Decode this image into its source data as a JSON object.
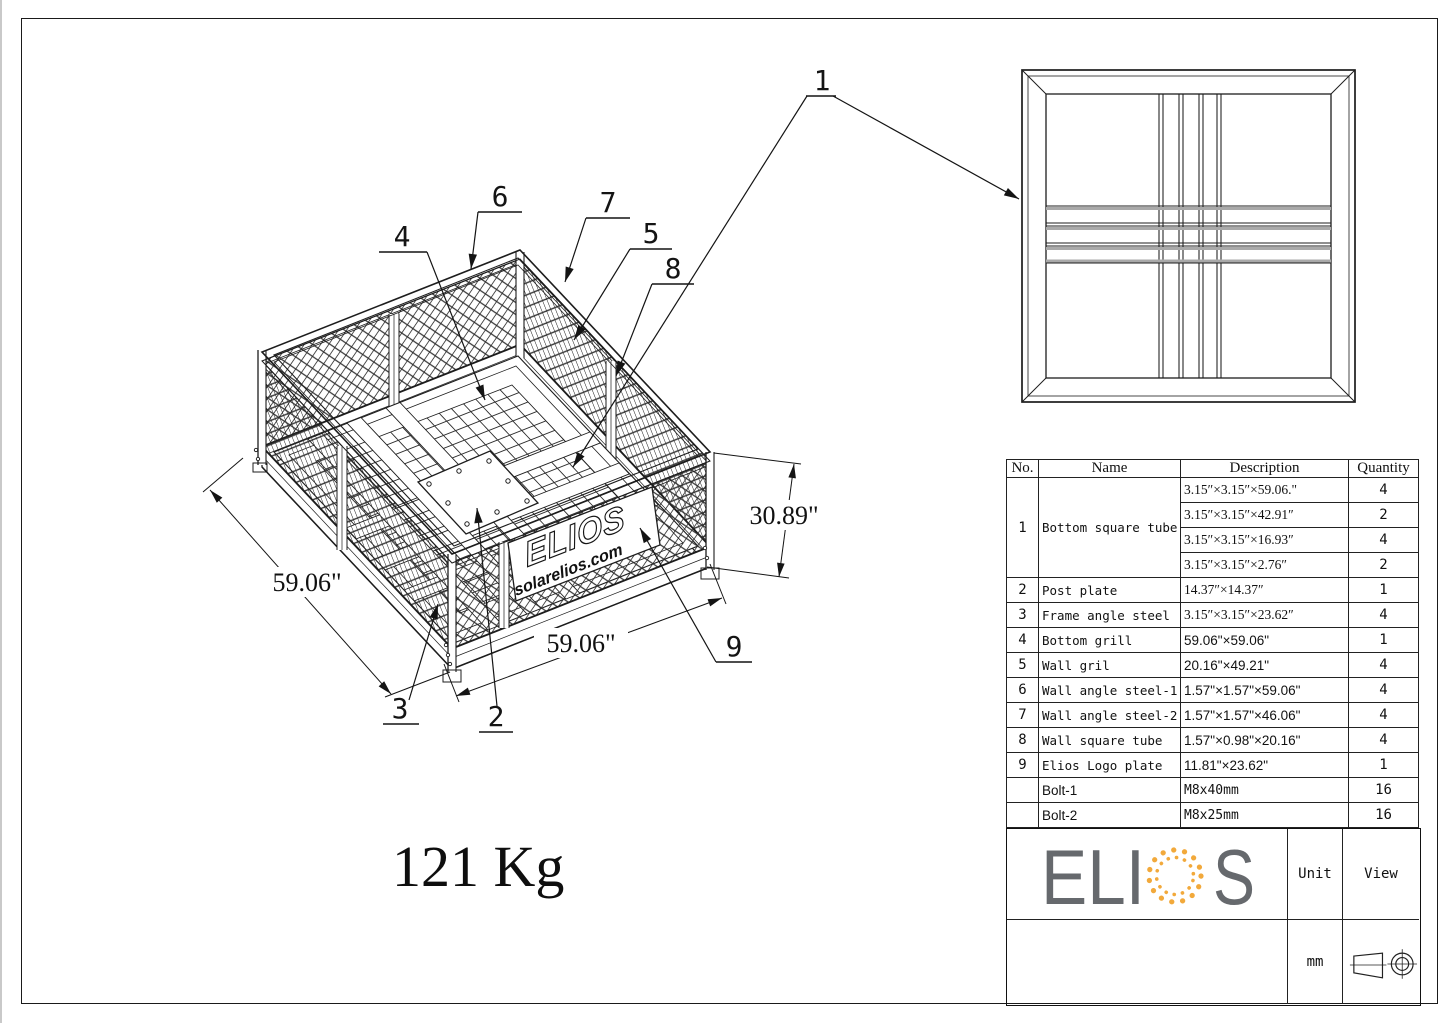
{
  "drawing": {
    "weight_label": "121 Kg",
    "callouts": [
      "1",
      "2",
      "3",
      "4",
      "5",
      "6",
      "7",
      "8",
      "9"
    ],
    "dimensions": {
      "left_width": "59.06\"",
      "front_width": "59.06\"",
      "height": "30.89\""
    },
    "logo_plate": {
      "brand": "ELIOS",
      "website": "solarelios.com"
    }
  },
  "parts_table": {
    "headers": [
      "No.",
      "Name",
      "Description",
      "Quantity"
    ],
    "item1": {
      "no": "1",
      "name": "Bottom square tube",
      "subs": [
        {
          "desc": "3.15″×3.15″×59.06.\"",
          "qty": "4"
        },
        {
          "desc": "3.15″×3.15″×42.91″",
          "qty": "2"
        },
        {
          "desc": "3.15″×3.15″×16.93″",
          "qty": "4"
        },
        {
          "desc": "3.15″×3.15″×2.76″",
          "qty": "2"
        }
      ]
    },
    "rows": [
      {
        "no": "2",
        "name": "Post plate",
        "desc": "14.37″×14.37″",
        "qty": "1"
      },
      {
        "no": "3",
        "name": "Frame angle steel",
        "desc": "3.15″×3.15″×23.62″",
        "qty": "4"
      },
      {
        "no": "4",
        "name": "Bottom grill",
        "desc": "59.06\"×59.06\"",
        "qty": "1"
      },
      {
        "no": "5",
        "name": "Wall gril",
        "desc": "20.16\"×49.21\"",
        "qty": "4"
      },
      {
        "no": "6",
        "name": "Wall angle steel-1",
        "desc": "1.57\"×1.57\"×59.06\"",
        "qty": "4"
      },
      {
        "no": "7",
        "name": "Wall angle steel-2",
        "desc": "1.57\"×1.57\"×46.06\"",
        "qty": "4"
      },
      {
        "no": "8",
        "name": "Wall square tube",
        "desc": "1.57\"×0.98\"×20.16\"",
        "qty": "4"
      },
      {
        "no": "9",
        "name": "Elios Logo plate",
        "desc": "11.81\"×23.62\"",
        "qty": "1"
      }
    ],
    "bolts": [
      {
        "name": "Bolt-1",
        "desc": "M8x40mm",
        "qty": "16"
      },
      {
        "name": "Bolt-2",
        "desc": "M8x25mm",
        "qty": "16"
      }
    ]
  },
  "title_block": {
    "brand": {
      "left": "ELI",
      "right": "S",
      "letter_color": "#66696d",
      "accent_color": "#f2a93b"
    },
    "unit_label": "Unit",
    "view_label": "View",
    "unit_value": "mm"
  }
}
